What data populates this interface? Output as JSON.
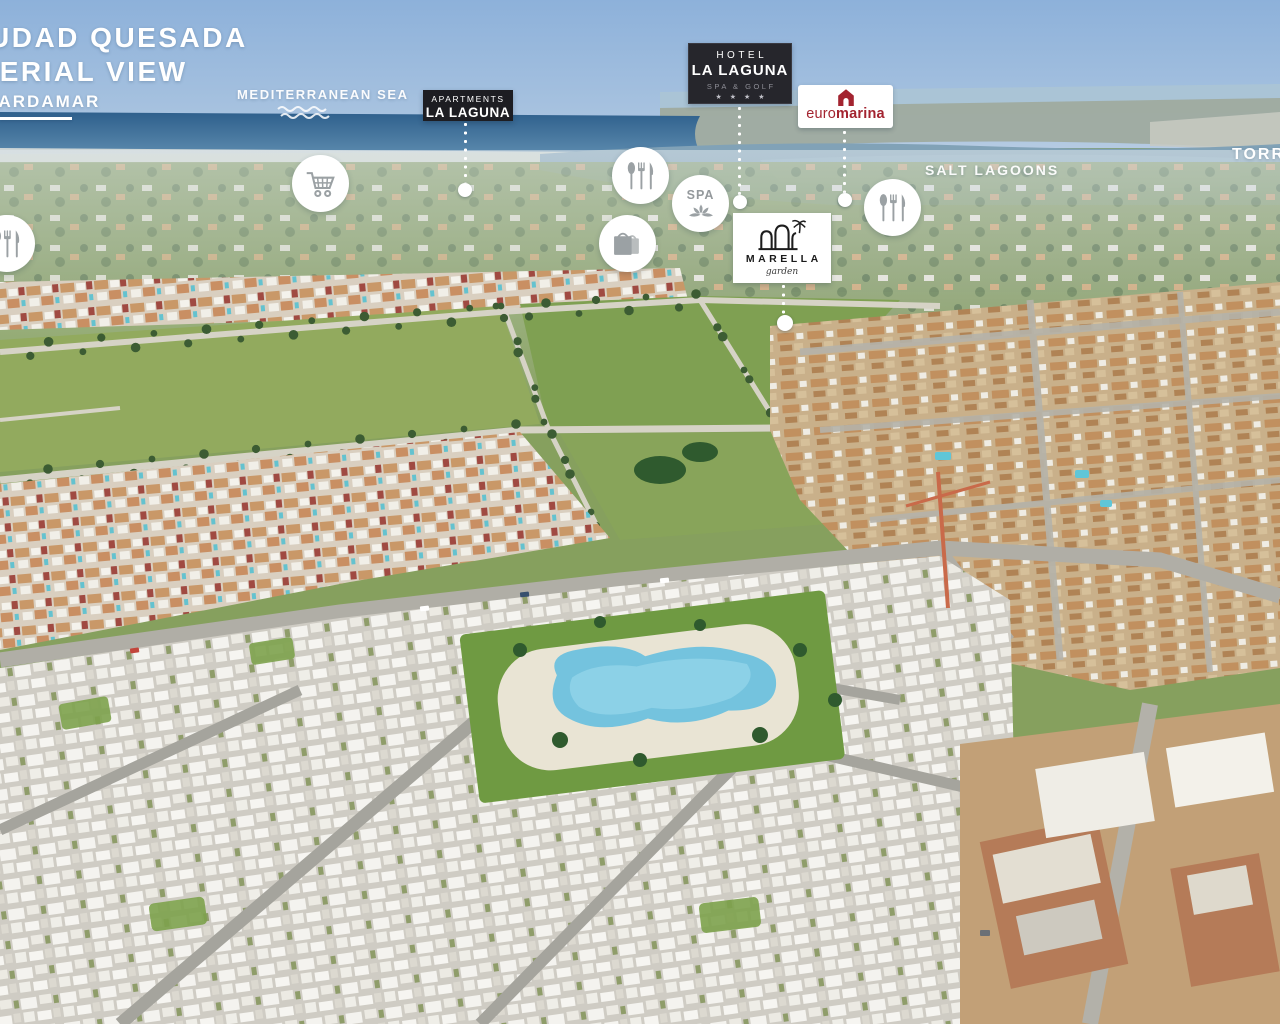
{
  "header": {
    "title_line1": "CIUDAD QUESADA",
    "title_line2": "AERIAL VIEW",
    "subtitle": "GUARDAMAR"
  },
  "geo_labels": {
    "mediterranean_sea": "MEDITERRANEAN SEA",
    "salt_lagoons": "SALT LAGOONS",
    "torrevieja": "TORREVIEJA"
  },
  "markers": {
    "apartments_la_laguna": {
      "line1": "APARTMENTS",
      "line2": "LA LAGUNA"
    },
    "hotel_la_laguna": {
      "line1": "HOTEL",
      "line2": "LA LAGUNA",
      "line3": "SPA & GOLF",
      "stars": "★ ★ ★ ★"
    },
    "euromarina": {
      "word_light": "euro",
      "word_bold": "marina",
      "brand_color": "#a32430",
      "icon": "euromarina-house-icon"
    },
    "marella_garden": {
      "name": "MARELLA",
      "tagline": "garden",
      "icon": "marella-arches-palm-icon"
    }
  },
  "amenities": {
    "spa_label": "SPA",
    "badges": [
      {
        "name": "restaurant-badge-west",
        "icon": "cutlery-icon"
      },
      {
        "name": "supermarket-badge",
        "icon": "shopping-cart-icon"
      },
      {
        "name": "restaurant-badge-center",
        "icon": "cutlery-icon"
      },
      {
        "name": "spa-badge",
        "icon": "spa-lotus-icon"
      },
      {
        "name": "shopping-badge",
        "icon": "shopping-bags-icon"
      },
      {
        "name": "restaurant-badge-east",
        "icon": "cutlery-icon"
      }
    ],
    "sea_icon": "waves-icon"
  },
  "colors": {
    "marker_label_bg": "#1d1d22",
    "hotel_label_bg": "#26262c",
    "euromarina_red": "#a32430",
    "overlay_text": "#ffffff"
  }
}
